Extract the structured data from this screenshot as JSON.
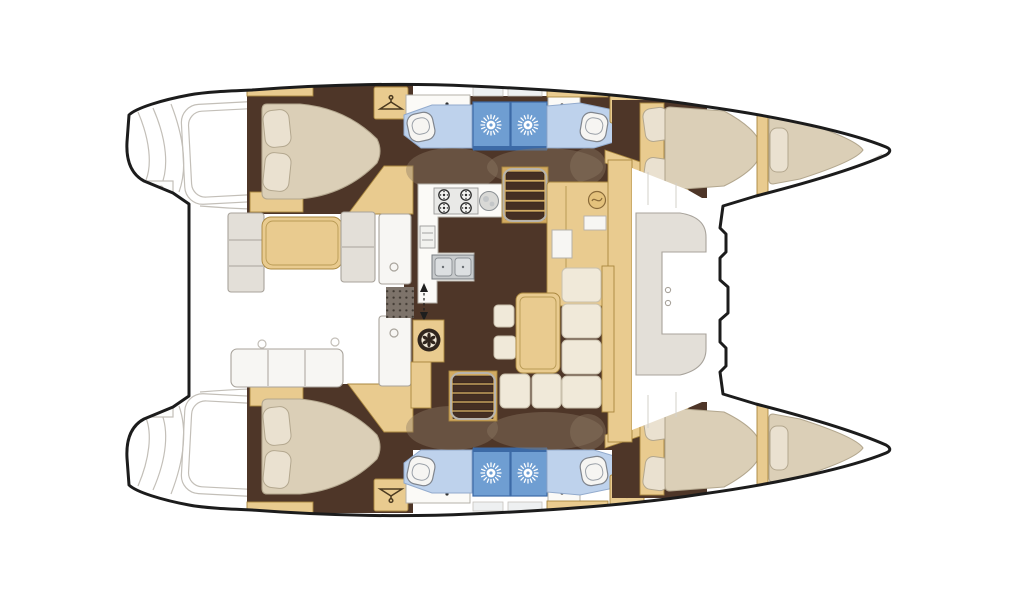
{
  "figure": {
    "type": "floorplan-diagram",
    "subject": "catamaran-yacht-accommodation-layout",
    "orientation": "bow-right",
    "hulls": 2
  },
  "rooms": [
    "aft-cabin-port",
    "bathroom-port-aft",
    "shower-port",
    "bathroom-port-fwd",
    "fwd-cabin-port",
    "bow-berth-port",
    "aft-cabin-starboard",
    "bathroom-starboard-aft",
    "shower-starboard",
    "bathroom-starboard-fwd",
    "fwd-cabin-starboard",
    "bow-berth-starboard",
    "galley",
    "salon",
    "nav-station",
    "aft-cockpit",
    "fwd-cockpit",
    "transom-steps-port",
    "transom-steps-starboard"
  ],
  "icons": [
    "shower-head-icon",
    "wardrobe-hanger-icon",
    "helm-wheel-icon",
    "nav-dial-icon",
    "stove-burner-icon",
    "round-sink-icon",
    "double-sink-icon",
    "fridge-icon",
    "companionway-arrows-icon",
    "stairs-icon",
    "toilet-icon"
  ],
  "counts": {
    "double_beds": 4,
    "bow_berths": 2,
    "shower_stalls": 4,
    "toilets": 4,
    "wardrobes": 4,
    "stove_burners": 4
  },
  "palette": {
    "outline": "#1c1c1c",
    "sketch_line": "#c3bfb8",
    "floor_dark_brown": "#4e3628",
    "wood_tan": "#e9cb8f",
    "wood_tan_dark": "#d2ab62",
    "wood_tan_edge": "#a9873f",
    "step_brown": "#452f23",
    "mattress_beige": "#dbcfb7",
    "mattress_edge": "#b3a78e",
    "pillow_cream": "#eae1d0",
    "cushion_cream": "#f0e9d9",
    "cushion_edge": "#c9c0ac",
    "cushion_gray": "#e3dfd8",
    "cushion_gray_edge": "#a8a39b",
    "shower_blue": "#6f9ed2",
    "shower_blue_dark": "#3c6aa6",
    "toilet_blue": "#bed2ec",
    "toilet_blue_edge": "#93abcd",
    "porcelain": "#f6f5f2",
    "steel": "#c7cacc",
    "mat_gray": "#7d736a",
    "shadow_taupe": "#8d7a63"
  }
}
